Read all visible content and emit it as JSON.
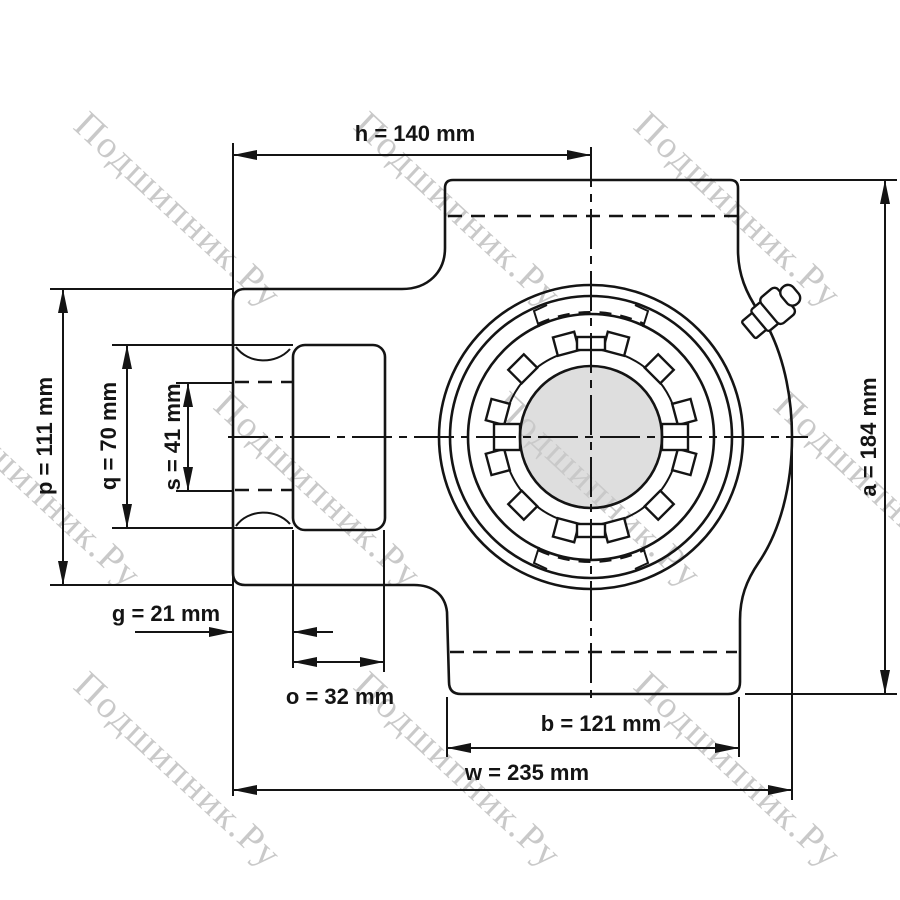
{
  "watermark": {
    "text": "Подшипник.Ру",
    "color": "#c9c9c9"
  },
  "drawing": {
    "bore_fill": "#dedede",
    "line_color": "#141414",
    "background": "#ffffff"
  },
  "dimensions": {
    "h": "h = 140 mm",
    "p": "p = 111 mm",
    "q": "q = 70 mm",
    "s": "s = 41 mm",
    "g": "g = 21 mm",
    "o": "o = 32 mm",
    "b": "b = 121 mm",
    "w": "w = 235 mm",
    "a": "a = 184 mm"
  }
}
